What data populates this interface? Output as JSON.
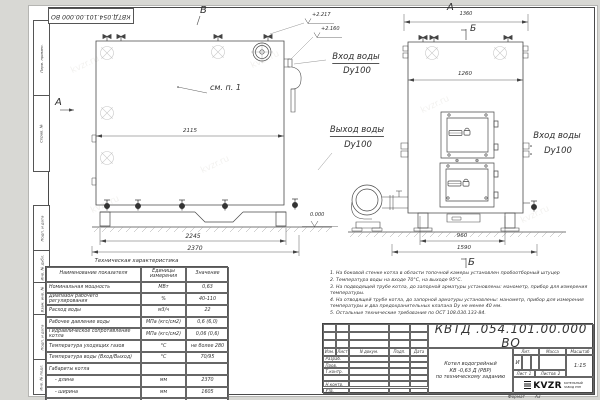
{
  "sheet": {
    "doc_number": "КВТД.054.101.00.000 ВО",
    "format_label": "Формат",
    "format_value": "А3",
    "watermark": "kvzr.ru"
  },
  "margin": {
    "labels": [
      "Перв. примен.",
      "Справ. №",
      "Подп. и дата",
      "Инв. № дубл.",
      "Взам. инв. №",
      "Подп. и дата",
      "Инв. № подл."
    ]
  },
  "views": {
    "front": {
      "label_top": "В",
      "label_left": "А",
      "callout": "см. п. 1",
      "dim_inner": "2115",
      "dim_skid": "2245",
      "dim_overall": "2370",
      "elev_zero": "0.000",
      "elev_top1": "+2.217",
      "elev_top2": "+2.160",
      "inlet_line1": "Вход воды",
      "inlet_line2": "Dy100",
      "outlet_line1": "Выход воды",
      "outlet_line2": "Dy100"
    },
    "side": {
      "label_top": "А",
      "section_top": "Б",
      "section_bottom": "Б",
      "dim_top": "1360",
      "dim_inner": "1260",
      "dim_base": "960",
      "dim_overall": "1590",
      "inlet_line1": "Вход воды",
      "inlet_line2": "Dy100"
    }
  },
  "tech_table": {
    "title": "Техническая характеристика",
    "headers": {
      "name": "Наименование показателя",
      "unit1": "Единицы",
      "unit2": "измерения",
      "value": "Значение"
    },
    "rows": [
      {
        "name": "Номинальная мощность",
        "unit": "МВт",
        "value": "0,63"
      },
      {
        "name": "Диапазон рабочего регулирования",
        "unit": "%",
        "value": "40-110"
      },
      {
        "name": "Расход воды",
        "unit": "м3/ч",
        "value": "22"
      },
      {
        "name": "Рабочее давление воды",
        "unit": "МПа (кгс/см2)",
        "value": "0,6 (6,0)"
      },
      {
        "name": "Гидравлическое сопротивление котла",
        "unit": "МПа (кгс/см2)",
        "value": "0,06 (0,6)"
      },
      {
        "name": "Температура уходящих газов",
        "unit": "°С",
        "value": "не более 280"
      },
      {
        "name": "Температура воды (Вход/Выход)",
        "unit": "°С",
        "value": "70/95"
      },
      {
        "name": "Габариты котла",
        "unit": "",
        "value": ""
      },
      {
        "name": "- длина",
        "unit": "мм",
        "value": "2370"
      },
      {
        "name": "- ширина",
        "unit": "мм",
        "value": "1605"
      },
      {
        "name": "- высота",
        "unit": "мм",
        "value": "2150"
      }
    ]
  },
  "notes": [
    "1. На боковой стенке котла в области топочной камеры установлен пробоотборный штуцер",
    "2. Температура воды на входе 70°С, на выходе 95°С.",
    "3. На подводящей трубе котла, до запорной арматуры установлены: манометр, прибор для измерения температуры.",
    "4. На отводящей трубе котла, до запорной арматуры установлены: манометр, прибор для измерения температуры и два предохранительных клапана Dу не менее 40 мм.",
    "5. Остальные технические требования по ОСТ 108.030.133-84."
  ],
  "title_block": {
    "doc_number": "КВТД .054.101.00.000  ВО",
    "product_name_1": "Котел водогрейный",
    "product_name_2": "КВ -0,63 Д  (РВР)",
    "product_name_3": "по техническому заданию",
    "lit_header": "Лит.",
    "mass_header": "Масса",
    "scale_header": "Масштаб",
    "lit_value": "И",
    "scale_value": "1:15",
    "sheet_label": "Лист",
    "sheet_value": "1",
    "sheets_label": "Листов",
    "sheets_value": "2",
    "logo_text": "KVZR",
    "logo_sub1": "КОТЕЛЬНЫЙ",
    "logo_sub2": "ЗАВОД РЭП",
    "rev_headers": [
      "Изм.",
      "Лист",
      "N докум.",
      "Подп.",
      "Дата"
    ],
    "sign_rows": [
      "Разраб.",
      "Пров.",
      "Т.контр.",
      "",
      "Н.контр.",
      "Утв."
    ]
  }
}
